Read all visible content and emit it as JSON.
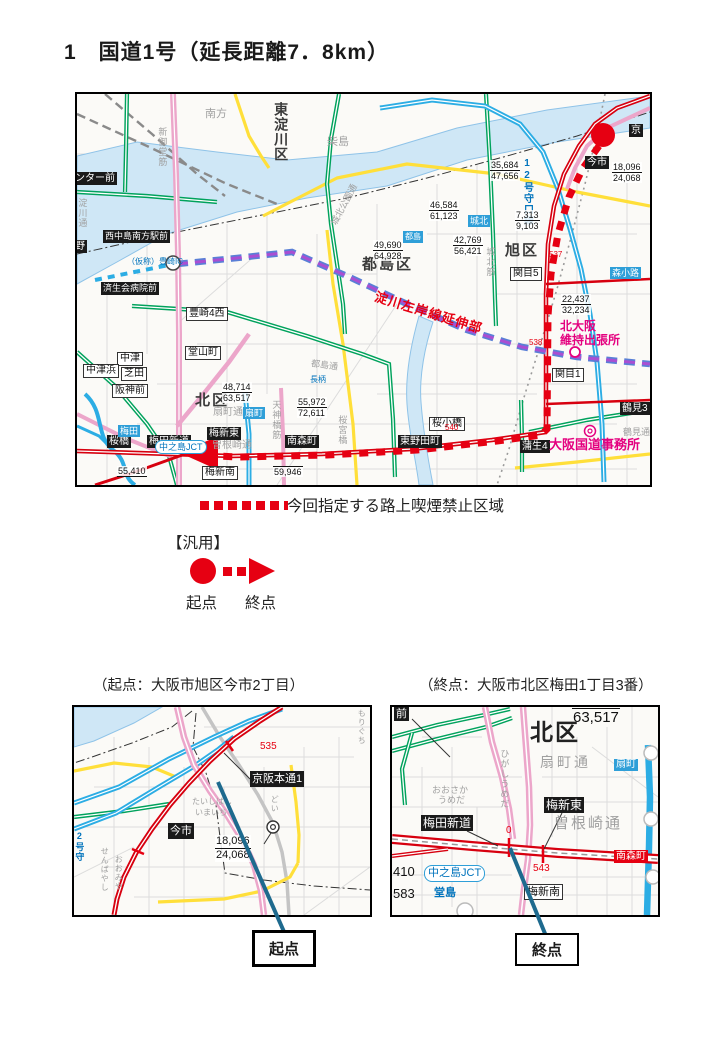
{
  "title": "1　国道1号（延長距離7．8km）",
  "colors": {
    "route_red": "#e60012",
    "road_red": "#d7000f",
    "road_pink": "#eca6ca",
    "road_green": "#00a25c",
    "road_yellow": "#ffdf3a",
    "road_cyan": "#2cade4",
    "water": "#cfe7f6",
    "planned_blue": "#5a7fd6",
    "planned_purple": "#a94fd2",
    "magenta_text": "#e4007f",
    "blue_text": "#0073bc",
    "teal_arrow": "#1e6a8e"
  },
  "legend": {
    "designated": "今回指定する路上喫煙禁止区域",
    "generic": "【汎用】",
    "start": "起点",
    "end": "終点"
  },
  "captions": {
    "start": "（起点：大阪市旭区今市2丁目）",
    "end": "（終点：大阪市北区梅田1丁目3番）"
  },
  "callouts": {
    "start": "起点",
    "end": "終点"
  },
  "mm": {
    "ward_higashiyodogawa": "東淀川区",
    "ward_miyakojima": "都島区",
    "ward_asahi": "旭区",
    "ward_kita": "北区",
    "minamikata": "南方",
    "kunijima": "柴島",
    "shinmidosuji": "新御堂筋",
    "yodogawadori": "淀川通",
    "johokusuji": "城北筋",
    "johokukoendori": "城北公園通",
    "miyakojimadori": "都島通",
    "tenjinbashisuji": "天神橋筋",
    "sakuranomiyabashi": "桜宮橋",
    "sonezakidori": "曽根崎通",
    "ogimachidori": "扇町通",
    "tsurumidori": "鶴見通",
    "center_mae": "ンター前",
    "no_label": "野",
    "nishinakajima": "西中島南方駅前",
    "saiseikai": "済生会病院前",
    "kyo": "京",
    "imaichi": "今市",
    "sakurabashi": "桜橋",
    "umedashindo": "梅田新道",
    "umeshinhigashi": "梅新東",
    "minamimorimachi": "南森町",
    "higashinoda": "東野田町",
    "gamo4": "蒲生4",
    "tsurumi3": "鶴見3",
    "toyosaki4": "豊崎4西",
    "doyama": "堂山町",
    "nakatsu": "中津",
    "nakatsuhama": "中津浜",
    "shibata": "芝田",
    "hanshinmae": "阪神前",
    "sekime1": "関目1",
    "sekime5": "関目5",
    "sakurakobashi": "桜小橋",
    "umeshinminami": "梅新南",
    "umeda": "梅田",
    "ogimachi": "扇町",
    "johoku": "城北",
    "miyakojima_st": "都島",
    "morishoji": "森小路",
    "nagara": "長柄",
    "nakanoshimajct": "中之島JCT",
    "toyosaki_ic": "（仮称）豊崎IC",
    "moriguchi_line": "12号守口線",
    "yosagansen": "淀川左岸線延伸部",
    "jimusho": "大阪国道事務所",
    "shucchojo1": "北大阪",
    "shucchojo2": "維持出張所",
    "r537": "537",
    "r538": "538",
    "r540": "540",
    "c1": {
      "t": "35,684",
      "b": "47,656"
    },
    "c2": {
      "t": "46,584",
      "b": "61,123"
    },
    "c3": {
      "t": "49,690",
      "b": "64,928"
    },
    "c4": {
      "t": "42,769",
      "b": "56,421"
    },
    "c5": {
      "t": "7,313",
      "b": "9,103"
    },
    "c6": {
      "t": "18,096",
      "b": "24,068"
    },
    "c7": {
      "t": "22,437",
      "b": "32,234"
    },
    "c8": {
      "t": "48,714",
      "b": "63,517"
    },
    "c9": {
      "t": "55,972",
      "b": "72,611"
    },
    "c10": "55,410",
    "c11": "59,946"
  },
  "i1": {
    "keihanhondori1": "京阪本通1",
    "imaichi": "今市",
    "r535": "535",
    "count": {
      "t": "18,096",
      "b": "24,068"
    },
    "taishibashi": "たいしばし",
    "imaichi_hira": "いまいち",
    "doi": "どい",
    "senbayashi": "せんばやし",
    "oomiya": "おおみや",
    "moriguchi": "もりぐち",
    "line12": "2号守"
  },
  "i2": {
    "mae": "前",
    "kitaku": "北区",
    "count": {
      "t": "48,714",
      "b": "63,517"
    },
    "ogimachidori": "扇町通",
    "ogimachi": "扇町",
    "umeshinhigashi": "梅新東",
    "sonezakidori": "曽根崎通",
    "umedashindo": "梅田新道",
    "r0": "0",
    "r543": "543",
    "minamimorimachi": "南森町",
    "nakanoshimajct": "中之島JCT",
    "n410": "410",
    "n583": "583",
    "dojima": "堂島",
    "umeshinminami": "梅新南",
    "higashiumeda": "ひがしうめだ",
    "osakaumeda1": "おおさか",
    "osakaumeda2": "うめだ"
  }
}
